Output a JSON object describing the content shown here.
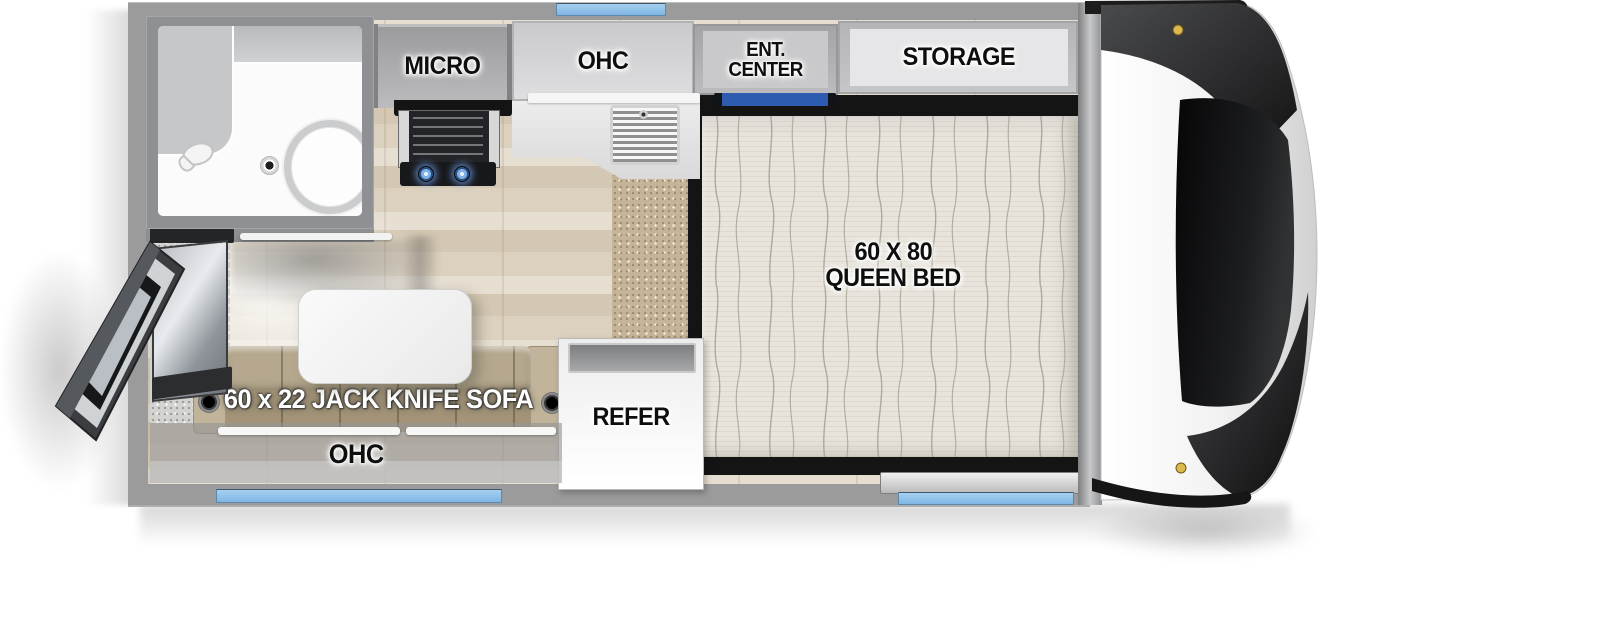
{
  "labels": {
    "micro": "MICRO",
    "ohc_kitchen": "OHC",
    "ent_center_line1": "ENT.",
    "ent_center_line2": "CENTER",
    "storage": "STORAGE",
    "bed_line1": "60 X 80",
    "bed_line2": "QUEEN BED",
    "refer": "REFER",
    "sofa": "60 x 22 JACK KNIFE SOFA",
    "ohc_sofa": "OHC"
  },
  "colors": {
    "wall_gray": "#9b9b9c",
    "window_blue": "#7fb6e4",
    "tv_blue": "#2d5bb0",
    "floor_wood": "#ddd3c2",
    "carpet_tan": "#c6b499",
    "mattress": "#e8e4db",
    "sofa_tan": "#b5a88e",
    "platform_black": "#141414",
    "clearance_light_amber": "#dcb84e"
  },
  "icons": {
    "toilet": "toilet-icon",
    "shower_head": "shower-head-icon",
    "sink_drain": "drain-icon",
    "cooktop": "two-burner-cooktop-icon",
    "sink_grate": "sink-grate-icon",
    "entry_door": "open-entry-door-icon",
    "front_cap": "truck-camper-front-cap"
  }
}
